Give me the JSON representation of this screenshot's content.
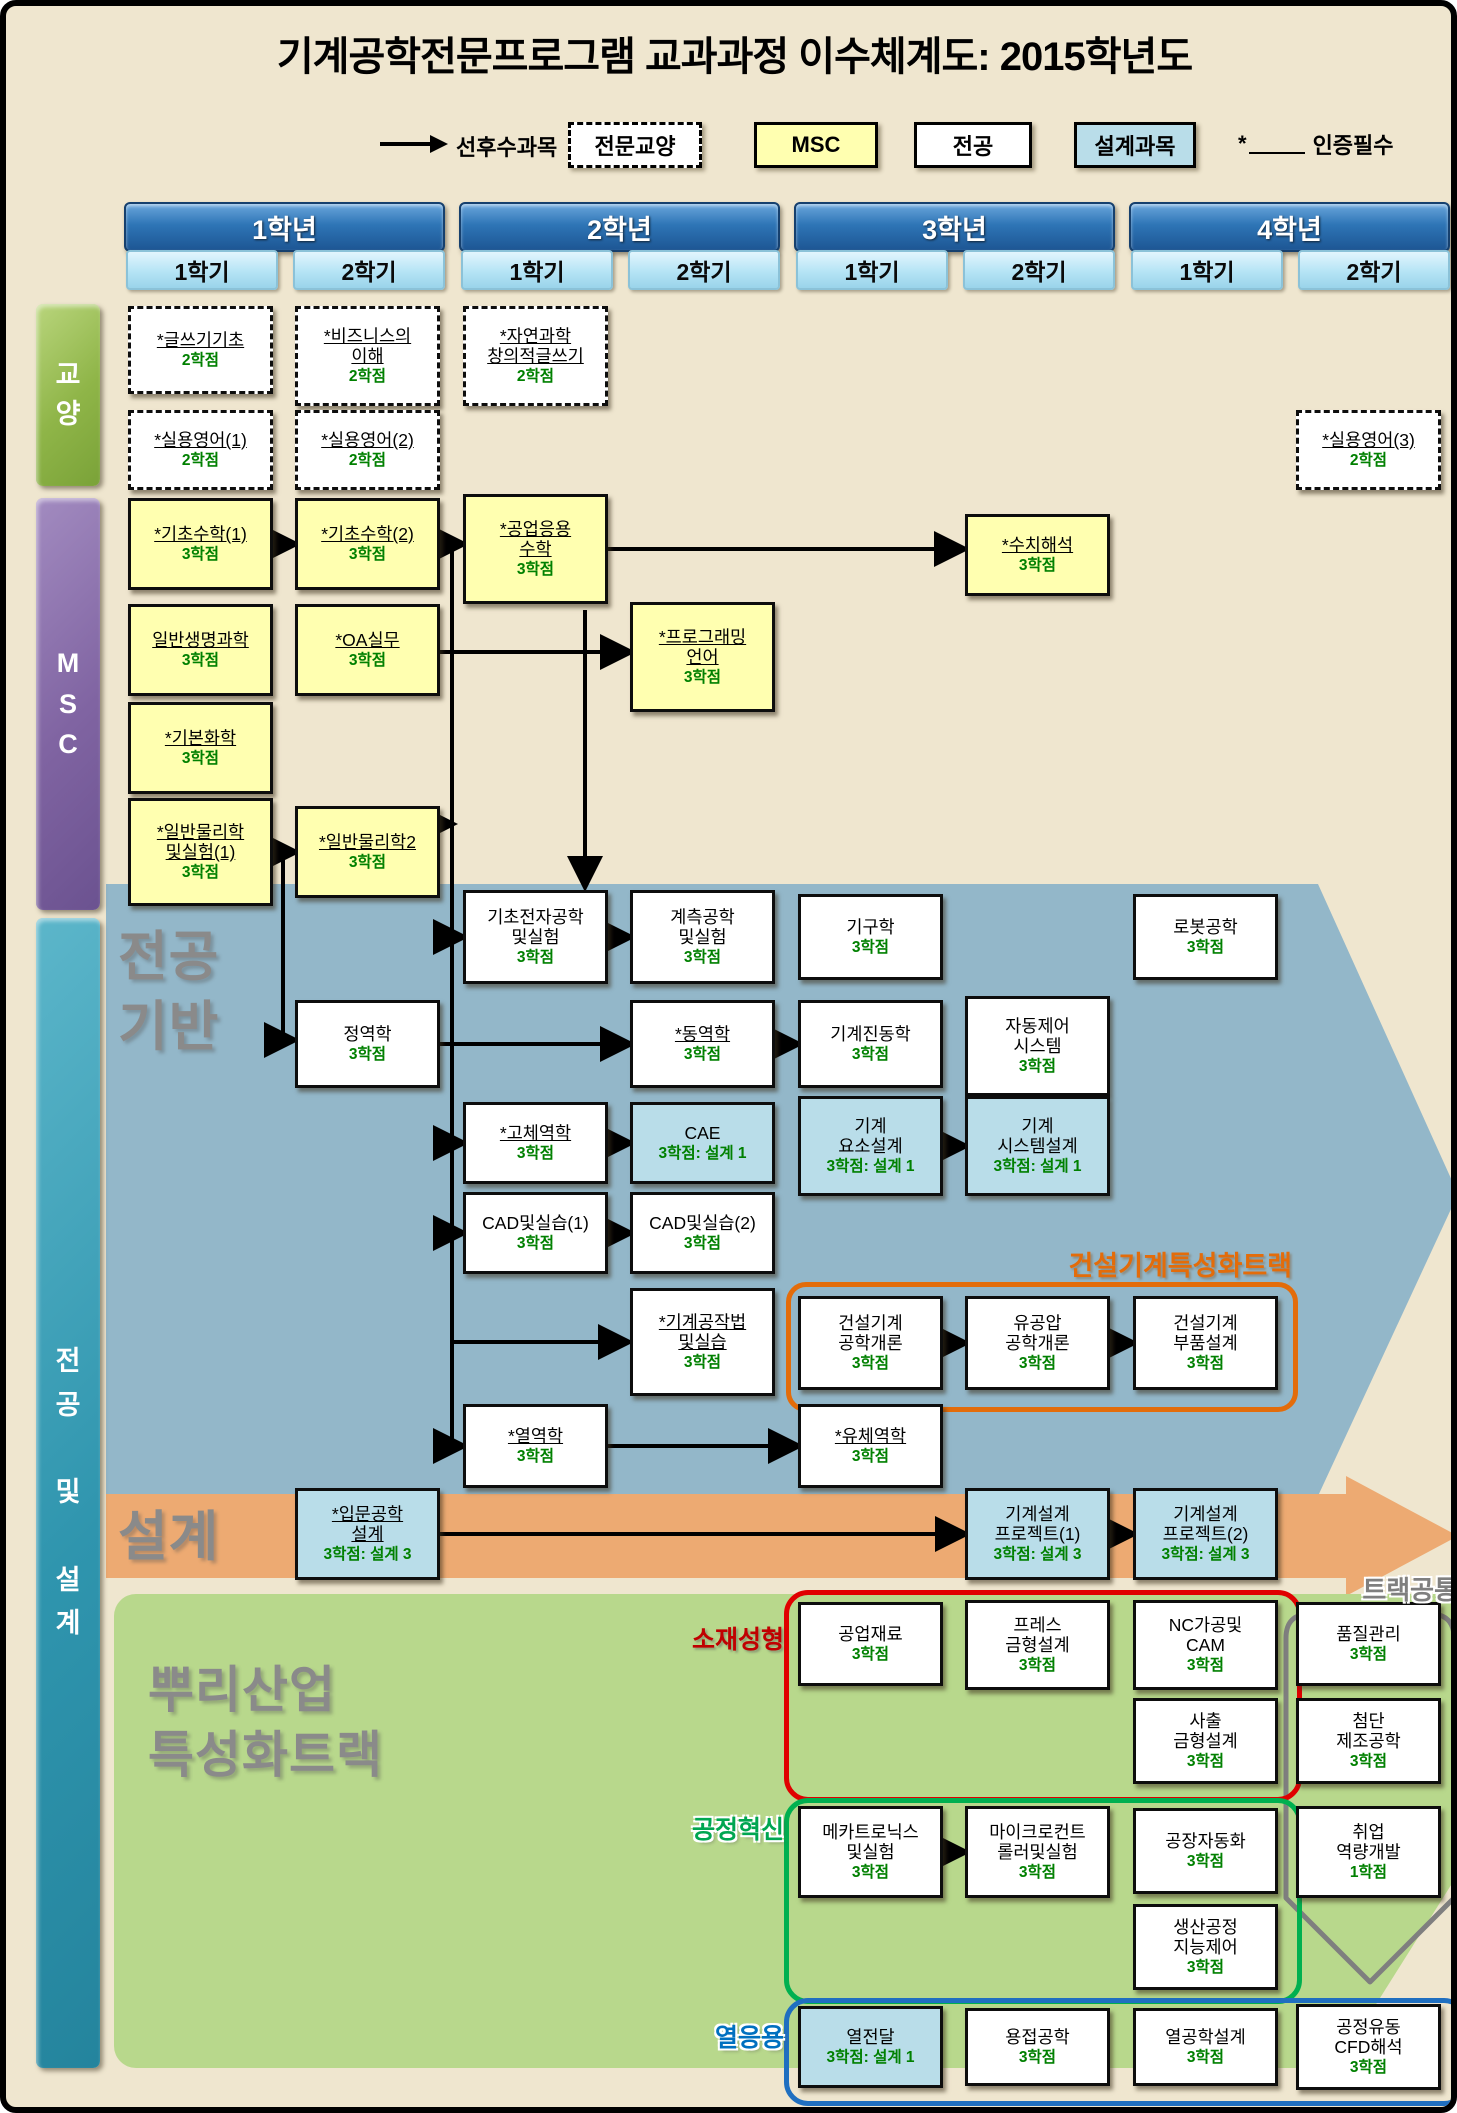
{
  "title": "기계공학전문프로그램 교과과정 이수체계도: 2015학년도",
  "legend": {
    "flow_label": "선후수과목",
    "types": [
      {
        "id": "liberal",
        "label": "전문교양"
      },
      {
        "id": "msc",
        "label": "MSC"
      },
      {
        "id": "major",
        "label": "전공"
      },
      {
        "id": "design",
        "label": "설계과목"
      }
    ],
    "cert": {
      "star": "*",
      "label": "인증필수"
    }
  },
  "years": [
    {
      "label": "1학년",
      "semesters": [
        "1학기",
        "2학기"
      ]
    },
    {
      "label": "2학년",
      "semesters": [
        "1학기",
        "2학기"
      ]
    },
    {
      "label": "3학년",
      "semesters": [
        "1학기",
        "2학기"
      ]
    },
    {
      "label": "4학년",
      "semesters": [
        "1학기",
        "2학기"
      ]
    }
  ],
  "sidebars": {
    "liberal": {
      "label": "교\n양"
    },
    "msc": {
      "label": "M\nS\nC"
    },
    "major_design": {
      "label": "전\n공\n\n및\n\n설\n계"
    }
  },
  "sections": {
    "major_base": "전공\n기반",
    "design": "설계",
    "root_track": "뿌리산업\n특성화트랙"
  },
  "tracks": {
    "construction": {
      "label": "건설기계특성화트랙",
      "color": "#e36c0a"
    },
    "material": {
      "label": "소재성형",
      "color": "#c00000"
    },
    "process": {
      "label": "공정혁신",
      "color": "#00a651"
    },
    "thermal": {
      "label": "열응용",
      "color": "#0070c0"
    },
    "track_common": {
      "label": "트랙공통",
      "color": "#7f7f7f"
    }
  },
  "colors": {
    "page_bg": "#efe6cf",
    "year_bar": "#2e75b6",
    "semester_bar": "#b5e4f5",
    "liberal_sidebar": "#8fb548",
    "msc_sidebar": "#8064a2",
    "major_sidebar": "#2f95ae",
    "msc_box": "#ffffb0",
    "design_box": "#b9dde9",
    "major_arrow_bg": "#93b7c9",
    "design_band": "#edaa72",
    "root_panel": "#b8d88c",
    "credit_text": "#008000"
  },
  "courses": [
    {
      "label": "*글쓰기기초",
      "credit": "2학점",
      "type": "liberal",
      "cert": true,
      "col": "c11",
      "y": 300,
      "h": 88
    },
    {
      "label": "*비즈니스의\n이해",
      "credit": "2학점",
      "type": "liberal",
      "cert": true,
      "col": "c12",
      "y": 300,
      "h": 100
    },
    {
      "label": "*자연과학\n창의적글쓰기",
      "credit": "2학점",
      "type": "liberal",
      "cert": true,
      "col": "c21",
      "y": 300,
      "h": 100
    },
    {
      "label": "*실용영어(1)",
      "credit": "2학점",
      "type": "liberal",
      "cert": true,
      "col": "c11",
      "y": 404,
      "h": 80
    },
    {
      "label": "*실용영어(2)",
      "credit": "2학점",
      "type": "liberal",
      "cert": true,
      "col": "c12",
      "y": 404,
      "h": 80
    },
    {
      "label": "*실용영어(3)",
      "credit": "2학점",
      "type": "liberal",
      "cert": true,
      "col": "c42",
      "y": 404,
      "h": 80
    },
    {
      "label": "*기초수학(1)",
      "credit": "3학점",
      "type": "msc",
      "cert": true,
      "col": "c11",
      "y": 492,
      "h": 92
    },
    {
      "label": "*기초수학(2)",
      "credit": "3학점",
      "type": "msc",
      "cert": true,
      "col": "c12",
      "y": 492,
      "h": 92
    },
    {
      "label": "*공업응용\n수학",
      "credit": "3학점",
      "type": "msc",
      "cert": true,
      "col": "c21",
      "y": 488,
      "h": 110
    },
    {
      "label": "*수치해석",
      "credit": "3학점",
      "type": "msc",
      "cert": true,
      "col": "c32",
      "y": 508,
      "h": 82
    },
    {
      "label": "일반생명과학",
      "credit": "3학점",
      "type": "msc",
      "cert": true,
      "col": "c11",
      "y": 598,
      "h": 92
    },
    {
      "label": "*OA실무",
      "credit": "3학점",
      "type": "msc",
      "cert": true,
      "col": "c12",
      "y": 598,
      "h": 92
    },
    {
      "label": "*프로그래밍\n언어",
      "credit": "3학점",
      "type": "msc",
      "cert": true,
      "col": "c22",
      "y": 596,
      "h": 110
    },
    {
      "label": "*기본화학",
      "credit": "3학점",
      "type": "msc",
      "cert": true,
      "col": "c11",
      "y": 696,
      "h": 92
    },
    {
      "label": "*일반물리학\n및실험(1)",
      "credit": "3학점",
      "type": "msc",
      "cert": true,
      "col": "c11",
      "y": 792,
      "h": 108
    },
    {
      "label": "*일반물리학2",
      "credit": "3학점",
      "type": "msc",
      "cert": true,
      "col": "c12",
      "y": 800,
      "h": 92
    },
    {
      "label": "기초전자공학\n및실험",
      "credit": "3학점",
      "type": "major",
      "cert": false,
      "col": "c21",
      "y": 884,
      "h": 94
    },
    {
      "label": "계측공학\n및실험",
      "credit": "3학점",
      "type": "major",
      "cert": false,
      "col": "c22",
      "y": 884,
      "h": 94
    },
    {
      "label": "기구학",
      "credit": "3학점",
      "type": "major",
      "cert": false,
      "col": "c31",
      "y": 888,
      "h": 86
    },
    {
      "label": "로봇공학",
      "credit": "3학점",
      "type": "major",
      "cert": false,
      "col": "c41",
      "y": 888,
      "h": 86
    },
    {
      "label": "정역학",
      "credit": "3학점",
      "type": "major",
      "cert": false,
      "col": "c12",
      "y": 994,
      "h": 88
    },
    {
      "label": "*동역학",
      "credit": "3학점",
      "type": "major",
      "cert": true,
      "col": "c22",
      "y": 994,
      "h": 88
    },
    {
      "label": "기계진동학",
      "credit": "3학점",
      "type": "major",
      "cert": false,
      "col": "c31",
      "y": 994,
      "h": 88
    },
    {
      "label": "자동제어\n시스템",
      "credit": "3학점",
      "type": "major",
      "cert": false,
      "col": "c32",
      "y": 990,
      "h": 100
    },
    {
      "label": "*고체역학",
      "credit": "3학점",
      "type": "major",
      "cert": true,
      "col": "c21",
      "y": 1096,
      "h": 82
    },
    {
      "label": "CAE",
      "credit": "3학점: 설계 1",
      "type": "design",
      "cert": false,
      "col": "c22",
      "y": 1096,
      "h": 82
    },
    {
      "label": "기계\n요소설계",
      "credit": "3학점: 설계 1",
      "type": "design",
      "cert": false,
      "col": "c31",
      "y": 1090,
      "h": 100
    },
    {
      "label": "기계\n시스템설계",
      "credit": "3학점: 설계 1",
      "type": "design",
      "cert": false,
      "col": "c32",
      "y": 1090,
      "h": 100
    },
    {
      "label": "CAD및실습(1)",
      "credit": "3학점",
      "type": "major",
      "cert": false,
      "col": "c21",
      "y": 1186,
      "h": 82
    },
    {
      "label": "CAD및실습(2)",
      "credit": "3학점",
      "type": "major",
      "cert": false,
      "col": "c22",
      "y": 1186,
      "h": 82
    },
    {
      "label": "*기계공작법\n및실습",
      "credit": "3학점",
      "type": "major",
      "cert": true,
      "col": "c22",
      "y": 1282,
      "h": 108
    },
    {
      "label": "건설기계\n공학개론",
      "credit": "3학점",
      "type": "major",
      "cert": false,
      "col": "c31",
      "y": 1290,
      "h": 94
    },
    {
      "label": "유공압\n공학개론",
      "credit": "3학점",
      "type": "major",
      "cert": false,
      "col": "c32",
      "y": 1290,
      "h": 94
    },
    {
      "label": "건설기계\n부품설계",
      "credit": "3학점",
      "type": "major",
      "cert": false,
      "col": "c41",
      "y": 1290,
      "h": 94
    },
    {
      "label": "*열역학",
      "credit": "3학점",
      "type": "major",
      "cert": true,
      "col": "c21",
      "y": 1398,
      "h": 84
    },
    {
      "label": "*유체역학",
      "credit": "3학점",
      "type": "major",
      "cert": true,
      "col": "c31",
      "y": 1398,
      "h": 84
    },
    {
      "label": "*입문공학\n설계",
      "credit": "3학점: 설계 3",
      "type": "design",
      "cert": true,
      "col": "c12",
      "y": 1482,
      "h": 92
    },
    {
      "label": "기계설계\n프로젝트(1)",
      "credit": "3학점: 설계 3",
      "type": "design",
      "cert": false,
      "col": "c32",
      "y": 1482,
      "h": 92
    },
    {
      "label": "기계설계\n프로젝트(2)",
      "credit": "3학점: 설계 3",
      "type": "design",
      "cert": false,
      "col": "c41",
      "y": 1482,
      "h": 92
    },
    {
      "label": "공업재료",
      "credit": "3학점",
      "type": "major",
      "cert": false,
      "col": "c31",
      "y": 1596,
      "h": 84
    },
    {
      "label": "프레스\n금형설계",
      "credit": "3학점",
      "type": "major",
      "cert": false,
      "col": "c32",
      "y": 1594,
      "h": 90
    },
    {
      "label": "NC가공및\nCAM",
      "credit": "3학점",
      "type": "major",
      "cert": false,
      "col": "c41",
      "y": 1594,
      "h": 90
    },
    {
      "label": "품질관리",
      "credit": "3학점",
      "type": "major",
      "cert": false,
      "col": "c42",
      "y": 1596,
      "h": 84
    },
    {
      "label": "사출\n금형설계",
      "credit": "3학점",
      "type": "major",
      "cert": false,
      "col": "c41",
      "y": 1692,
      "h": 86
    },
    {
      "label": "첨단\n제조공학",
      "credit": "3학점",
      "type": "major",
      "cert": false,
      "col": "c42",
      "y": 1692,
      "h": 86
    },
    {
      "label": "메카트로닉스\n및실험",
      "credit": "3학점",
      "type": "major",
      "cert": false,
      "col": "c31",
      "y": 1800,
      "h": 92
    },
    {
      "label": "마이크로컨트\n롤러및실험",
      "credit": "3학점",
      "type": "major",
      "cert": false,
      "col": "c32",
      "y": 1800,
      "h": 92
    },
    {
      "label": "공장자동화",
      "credit": "3학점",
      "type": "major",
      "cert": false,
      "col": "c41",
      "y": 1802,
      "h": 86
    },
    {
      "label": "취업\n역량개발",
      "credit": "1학점",
      "type": "major",
      "cert": false,
      "col": "c42",
      "y": 1800,
      "h": 92
    },
    {
      "label": "생산공정\n지능제어",
      "credit": "3학점",
      "type": "major",
      "cert": false,
      "col": "c41",
      "y": 1898,
      "h": 86
    },
    {
      "label": "열전달",
      "credit": "3학점: 설계 1",
      "type": "design",
      "cert": false,
      "col": "c31",
      "y": 2000,
      "h": 82
    },
    {
      "label": "용접공학",
      "credit": "3학점",
      "type": "major",
      "cert": false,
      "col": "c32",
      "y": 2002,
      "h": 78
    },
    {
      "label": "열공학설계",
      "credit": "3학점",
      "type": "major",
      "cert": false,
      "col": "c41",
      "y": 2002,
      "h": 78
    },
    {
      "label": "공정유동\nCFD해석",
      "credit": "3학점",
      "type": "major",
      "cert": false,
      "col": "c42",
      "y": 1998,
      "h": 86
    }
  ],
  "connections": {
    "trunks": [
      [
        [
          446,
          538
        ],
        [
          446,
          1440
        ]
      ],
      [
        [
          277,
          846
        ],
        [
          277,
          1034
        ]
      ]
    ],
    "arrows": [
      [
        267,
        538,
        287,
        538
      ],
      [
        434,
        538,
        455,
        538
      ],
      [
        602,
        543,
        956,
        543
      ],
      [
        434,
        646,
        622,
        646
      ],
      [
        267,
        846,
        287,
        846
      ],
      [
        434,
        818,
        444,
        818
      ],
      [
        446,
        931,
        455,
        931
      ],
      [
        446,
        1137,
        455,
        1137
      ],
      [
        446,
        1227,
        455,
        1227
      ],
      [
        446,
        1336,
        620,
        1336
      ],
      [
        446,
        1440,
        455,
        1440
      ],
      [
        277,
        1034,
        286,
        1034
      ],
      [
        579,
        604,
        579,
        878
      ],
      [
        602,
        931,
        622,
        931
      ],
      [
        434,
        1038,
        622,
        1038
      ],
      [
        769,
        1038,
        790,
        1038
      ],
      [
        602,
        1137,
        622,
        1137
      ],
      [
        937,
        1140,
        957,
        1140
      ],
      [
        602,
        1227,
        622,
        1227
      ],
      [
        937,
        1337,
        957,
        1337
      ],
      [
        1104,
        1337,
        1125,
        1337
      ],
      [
        602,
        1440,
        790,
        1440
      ],
      [
        434,
        1528,
        957,
        1528
      ],
      [
        1104,
        1528,
        1125,
        1528
      ],
      [
        937,
        1846,
        957,
        1846
      ]
    ]
  }
}
